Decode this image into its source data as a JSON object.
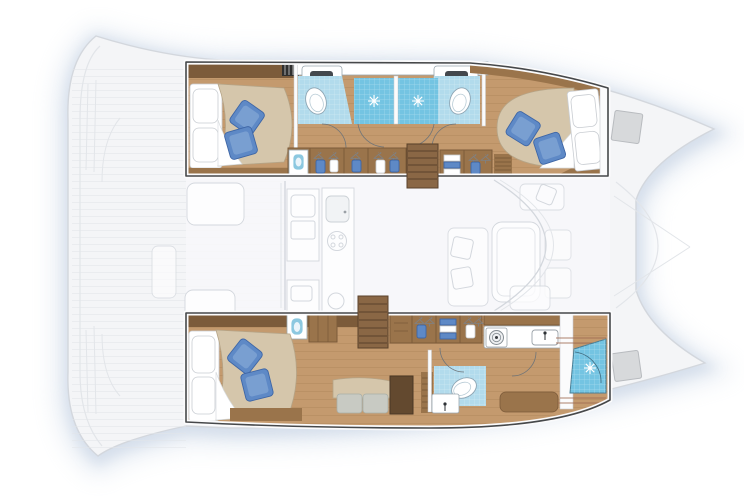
{
  "meta": {
    "description": "Top-down interior layout plan of a sailing catamaran, bow pointing right, showing two hulls with cabins, bathrooms, showers and wardrobes, and a central bridgedeck with cockpit, galley and saloon",
    "view": "top-down floor plan",
    "bow_direction": "right",
    "text_on_image": ""
  },
  "vessel": {
    "type": "catamaran",
    "port_hull_rooms": [
      "aft double cabin with beige duvet, white pillows and two blue accent pillows",
      "aft bathroom with washbasin and toilet on blue tile",
      "twin shower cubicles with blue tile and shower roses",
      "forward bathroom with washbasin and toilet on blue tile",
      "hanging wardrobe lockers with clothes",
      "companionway stairs",
      "forward double cabin with beige duvet and two blue accent pillows"
    ],
    "starboard_hull_rooms": [
      "aft double cabin with beige duvet, white pillows and two blue accent pillows",
      "settee with two cushions and desk",
      "companionway stairs",
      "hanging wardrobe lockers with clothes",
      "washing machine and sink counter",
      "bathroom with toilet and washbasin on blue tile",
      "forward shower room with blue tile",
      "forepeak with deck hatch"
    ],
    "bridgedeck_areas": [
      "aft cockpit with two tables",
      "galley with double sink and burner hob",
      "saloon dining table with seating",
      "forward bulkhead and trampoline deck with hatches"
    ]
  },
  "palette": {
    "page_bg": "#ffffff",
    "shadow": "#c6d3e4",
    "deck_fill": "#f4f5f7",
    "deck_line": "#e2e5e9",
    "deck_line_dark": "#d3d7dd",
    "outline": "#46484a",
    "wood": "#c49a6e",
    "wood_line": "#a67e52",
    "wood_mid": "#9a744b",
    "wood_dark": "#7c5b3a",
    "wood_desk": "#63492f",
    "duvet": "#d5c6ab",
    "duvet_edge": "#b5a487",
    "linen": "#ffffff",
    "linen_edge": "#c9cdd2",
    "pillow_blue": "#5e89c6",
    "pillow_blue_dark": "#3e66a6",
    "pillow_blue_light": "#8fb0da",
    "tile_light": "#b2dbec",
    "tile_mid": "#8cc8e0",
    "shower_blue": "#74c4e2",
    "fixture_white": "#ffffff",
    "fixture_stroke": "#9aa7b0",
    "sink_dark": "#44484d",
    "hatch_gray": "#d7d9db",
    "hatch_stroke": "#b8bbbf",
    "cushion_gray": "#c8cac3",
    "trim_red": "#a06a52"
  }
}
